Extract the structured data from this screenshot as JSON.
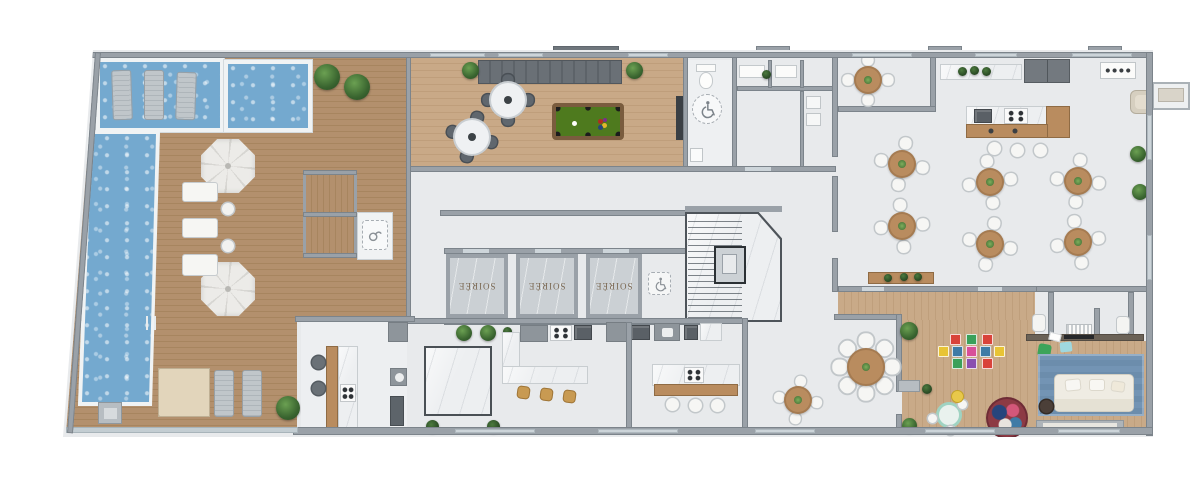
{
  "elevators": [
    {
      "label": "SOIRÉE"
    },
    {
      "label": "SOIRÉE"
    },
    {
      "label": "SOIRÉE"
    }
  ],
  "icons": {
    "restroom": "wheelchair-icon",
    "lobby": "wheelchair-icon",
    "deck": "shower-icon"
  },
  "colors": {
    "pool_water": "#74a9cf",
    "deck_wood": "#b3906d",
    "games_wood": "#c9a987",
    "kids_wood": "#c9aa88",
    "floor": "#e8eaec",
    "wall": "#9aa1a8",
    "felt": "#4e7a1e",
    "marble": "#edeff1",
    "table_wood": "#b98c5f",
    "stool_tan": "#c89a52",
    "rug_blue": "#7394b4",
    "sofa_cream": "#efece3",
    "plant_green": "#39642f"
  }
}
